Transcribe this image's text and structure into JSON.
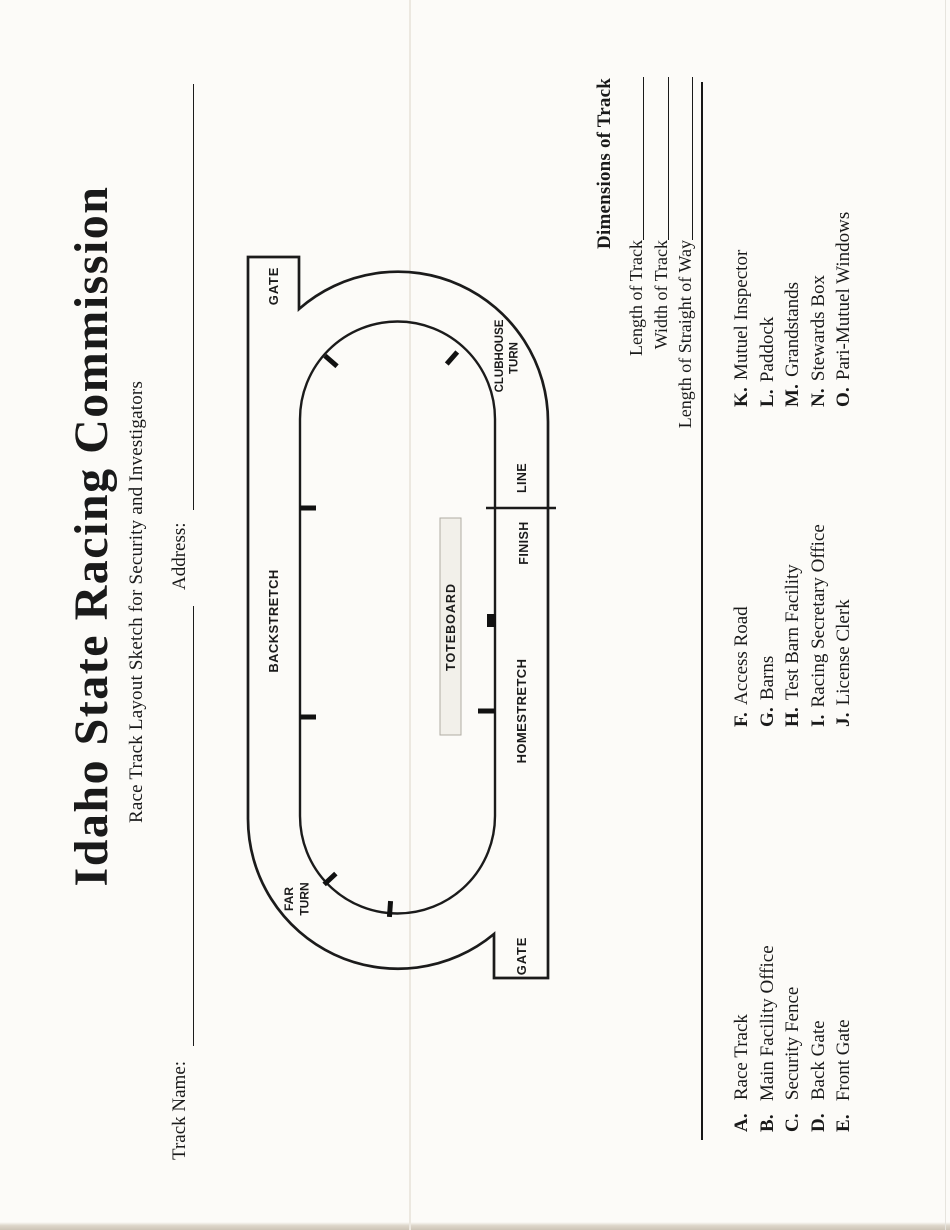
{
  "page": {
    "title": "Idaho State Racing Commission",
    "subtitle": "Race Track Layout Sketch for Security and Investigators",
    "track_name_label": "Track Name:",
    "track_name_value": "",
    "address_label": "Address:",
    "address_value": ""
  },
  "diagram": {
    "gate_top_label": "GATE",
    "gate_bottom_label": "GATE",
    "backstretch_label": "BACKSTRETCH",
    "homestretch_label": "HOMESTRETCH",
    "finish_label": "FINISH",
    "line_label": "LINE",
    "far_turn_line1": "FAR",
    "far_turn_line2": "TURN",
    "clubhouse_line1": "CLUBHOUSE",
    "clubhouse_line2": "TURN",
    "toteboard_label": "TOTEBOARD"
  },
  "dimensions": {
    "heading": "Dimensions of Track",
    "rows": [
      {
        "label": "Length of Track",
        "value": ""
      },
      {
        "label": "Width of Track",
        "value": ""
      },
      {
        "label": "Length of Straight of Way",
        "value": ""
      }
    ]
  },
  "legend": {
    "columns": [
      {
        "items": [
          {
            "key": "A.",
            "label": "Race Track"
          },
          {
            "key": "B.",
            "label": "Main Facility Office"
          },
          {
            "key": "C.",
            "label": "Security Fence"
          },
          {
            "key": "D.",
            "label": "Back Gate"
          },
          {
            "key": "E.",
            "label": "Front Gate"
          }
        ]
      },
      {
        "items": [
          {
            "key": "F.",
            "label": "Access Road"
          },
          {
            "key": "G.",
            "label": "Barns"
          },
          {
            "key": "H.",
            "label": "Test Barn Facility"
          },
          {
            "key": "I.",
            "label": "Racing Secretary Office"
          },
          {
            "key": "J.",
            "label": "License Clerk"
          }
        ]
      },
      {
        "items": [
          {
            "key": "K.",
            "label": "Mutuel Inspector"
          },
          {
            "key": "L.",
            "label": "Paddock"
          },
          {
            "key": "M.",
            "label": "Grandstands"
          },
          {
            "key": "N.",
            "label": "Stewards Box"
          },
          {
            "key": "O.",
            "label": "Pari-Mutuel Windows"
          }
        ]
      }
    ]
  },
  "colors": {
    "ink": "#1b1b1b",
    "paper": "#fcfbf8",
    "toteboard_fill": "#f2f0ea"
  }
}
